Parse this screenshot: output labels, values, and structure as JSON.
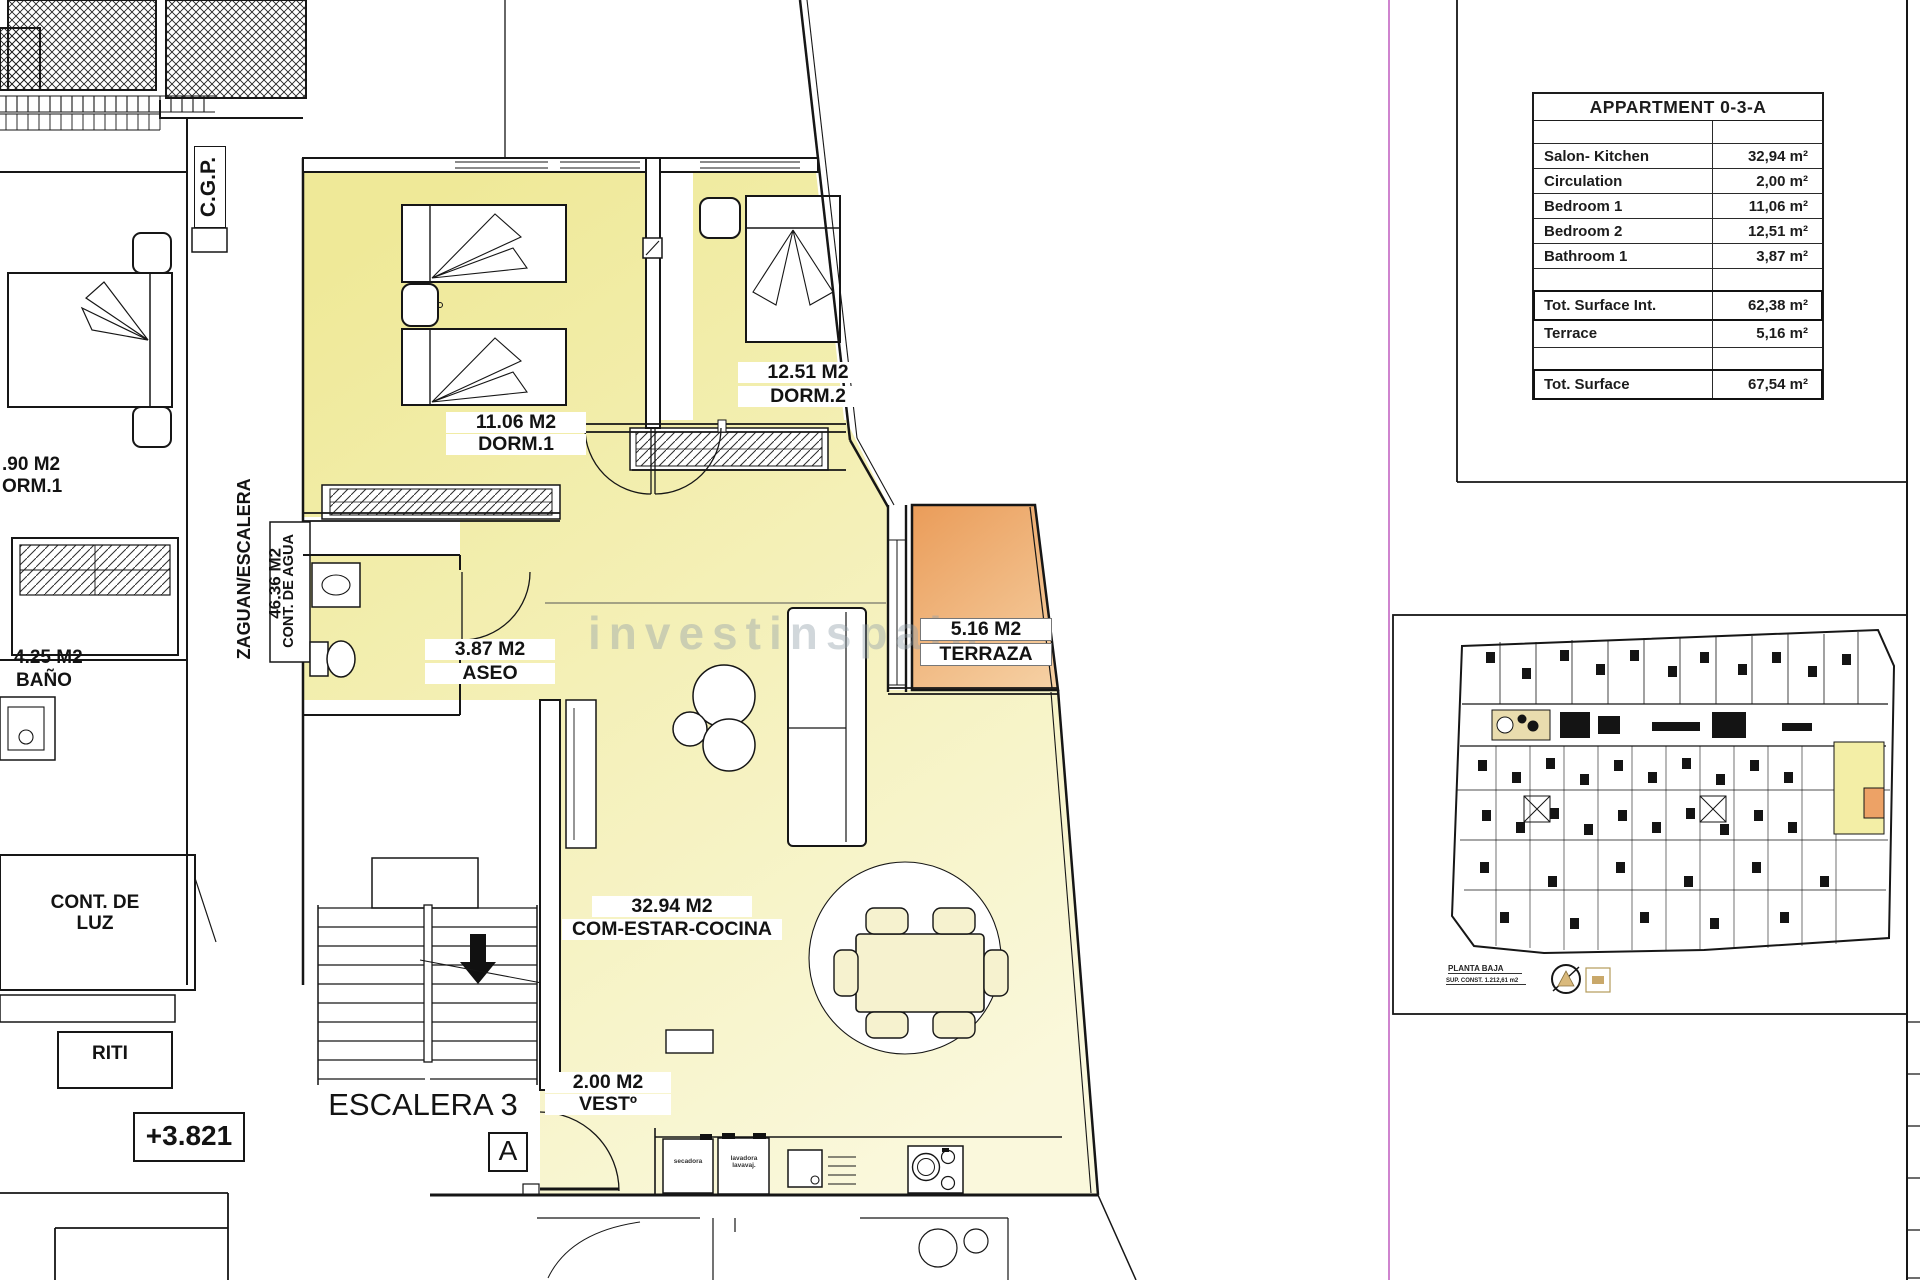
{
  "colors": {
    "room_fill": "#efe998",
    "room_fill_light": "#faf8dc",
    "terrace_dark": "#ea9c59",
    "terrace_light": "#f6d2a6",
    "wall_line": "#161616",
    "page_border_magenta": "#c365c3",
    "watermark_gray": "#96a0aa",
    "mini_plan_highlight": "#f3eea6",
    "mini_plan_kitchen_tan": "#e9dcae"
  },
  "watermark": "investinspain",
  "plan": {
    "labels": {
      "cgp": "C.G.P.",
      "zaguan_line1": "ZAGUAN/ESCALERA",
      "zaguan_line2": "46.36 M2",
      "cont_agua": "CONT. DE AGUA",
      "neighbor_dorm_area": ".90 M2",
      "neighbor_dorm_name": "ORM.1",
      "neighbor_bath_area": "4.25 M2",
      "neighbor_bath_name": "BAÑO",
      "cont_luz": "CONT. DE LUZ",
      "riti": "RITI",
      "level_mark": "+3.821",
      "stair_name": "ESCALERA 3",
      "stair_letter": "A",
      "dorm1_area": "11.06 M2",
      "dorm1_name": "DORM.1",
      "dorm2_area": "12.51 M2",
      "dorm2_name": "DORM.2",
      "aseo_area": "3.87 M2",
      "aseo_name": "ASEO",
      "terraza_area": "5.16 M2",
      "terraza_name": "TERRAZA",
      "salon_area": "32.94 M2",
      "salon_name": "COM-ESTAR-COCINA",
      "vest_area": "2.00 M2",
      "vest_name": "VESTº",
      "appliance1": "secadora",
      "appliance2": "lavadora lavavaj."
    }
  },
  "table": {
    "title": "APPARTMENT 0-3-A",
    "rows": [
      {
        "label": "Salon- Kitchen",
        "value": "32,94 m²"
      },
      {
        "label": "Circulation",
        "value": "2,00 m²"
      },
      {
        "label": "Bedroom 1",
        "value": "11,06 m²"
      },
      {
        "label": "Bedroom 2",
        "value": "12,51 m²"
      },
      {
        "label": "Bathroom 1",
        "value": "3,87 m²"
      }
    ],
    "totals": [
      {
        "label": "Tot. Surface Int.",
        "value": "62,38 m²"
      },
      {
        "label": "Terrace",
        "value": "5,16 m²"
      },
      {
        "label": "Tot. Surface",
        "value": "67,54 m²"
      }
    ]
  },
  "mini_plan": {
    "caption_line1": "PLANTA BAJA",
    "caption_line2": "SUP. CONST. 1.212,61 m2"
  }
}
